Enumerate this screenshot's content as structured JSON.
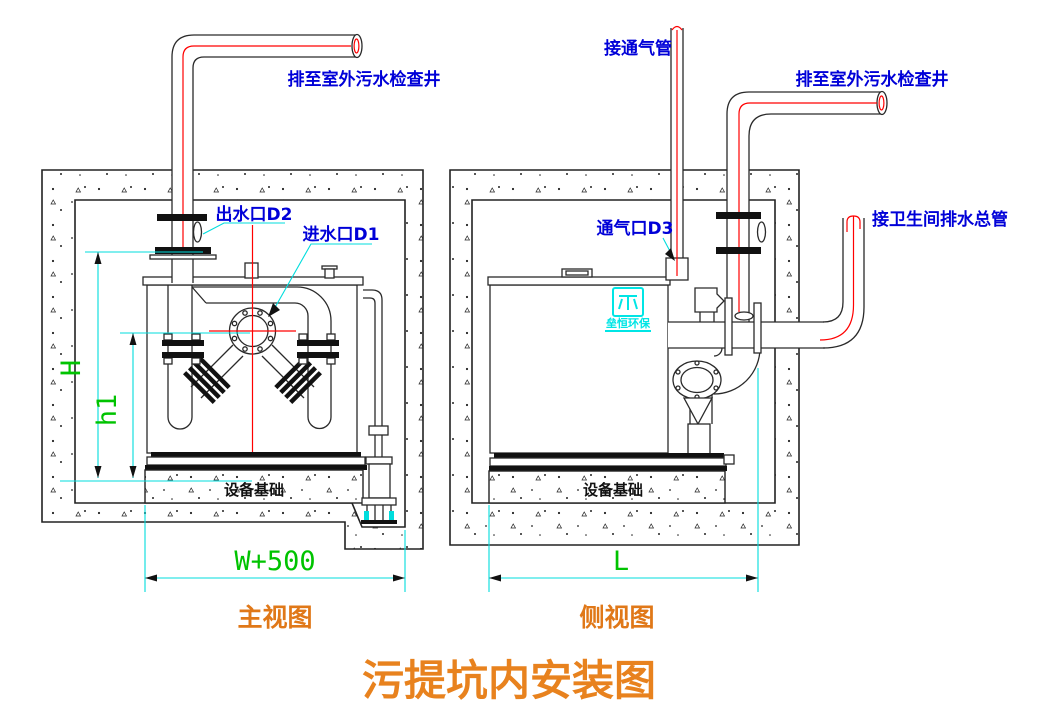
{
  "title": "污提坑内安装图",
  "front_view": {
    "caption": "主视图",
    "labels": {
      "discharge_pipe": "排至室外污水检查井",
      "outlet_port": "出水口D2",
      "inlet_port": "进水口D1",
      "foundation": "设备基础"
    },
    "dimensions": {
      "overall_height": "H",
      "inlet_height": "h1",
      "pit_width": "W+500"
    }
  },
  "side_view": {
    "caption": "侧视图",
    "labels": {
      "vent_connection": "接通气管",
      "discharge_pipe": "排至室外污水检查井",
      "vent_port": "通气口D3",
      "toilet_drain_main": "接卫生间排水总管",
      "foundation": "设备基础"
    },
    "dimensions": {
      "pit_length": "L"
    },
    "logo_text": "垒恒环保"
  },
  "colors": {
    "label_blue": "#0000d8",
    "dimension_green": "#00c300",
    "dimension_cyan": "#00dddd",
    "centerline_red": "#ff0000",
    "caption_orange": "#e07818",
    "line_black": "#222222"
  }
}
